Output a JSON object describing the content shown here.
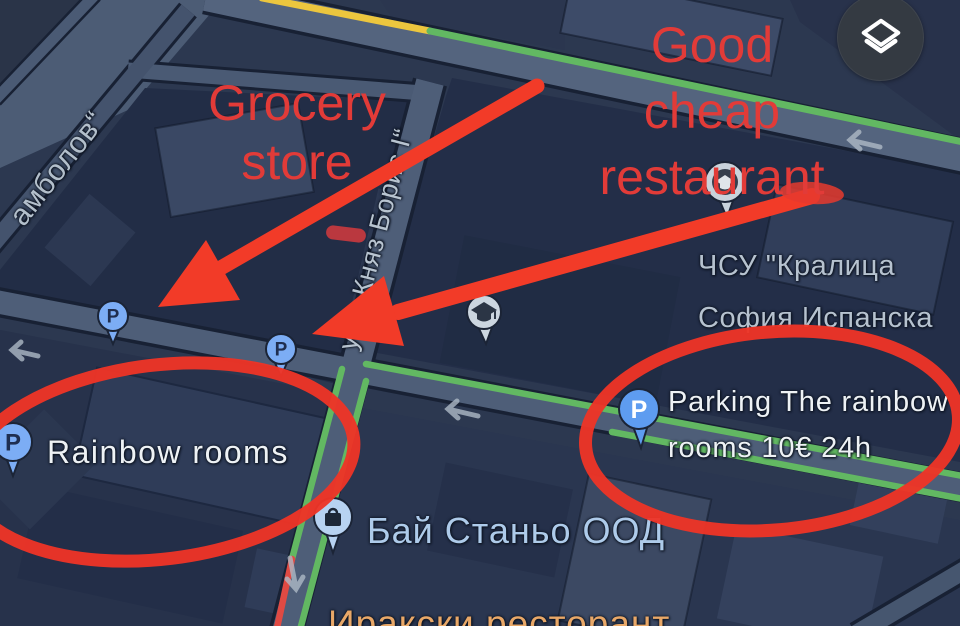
{
  "colors": {
    "annotation_red": "#ee3a2c",
    "pin_blue": "#7cadf5",
    "traffic_green": "#62b862",
    "traffic_yellow": "#ecc63e",
    "traffic_red": "#e04a43",
    "map_background": "#2c3850",
    "label_white": "#eef2f5",
    "label_blue": "#aecbea",
    "label_orange": "#e9a868",
    "label_grey": "#b3bfcb"
  },
  "annotations": {
    "grocery_store": {
      "line1": "Grocery",
      "line2": "store"
    },
    "good_cheap_restaurant": {
      "line1": "Good",
      "line2": "cheap",
      "line3": "restaurant"
    }
  },
  "poi_labels": {
    "rainbow_rooms": "Rainbow rooms",
    "parking": {
      "line1": "Parking The rainbow",
      "line2": "rooms 10€ 24h"
    },
    "school": {
      "line1": "ЧСУ \"Кралица",
      "line2": "София Испанска"
    },
    "bay_stanyo": "Бай Станьо ООД",
    "iraqi_restaurant": "Иракски ресторант"
  },
  "street_labels": {
    "stambolov": "амболов“",
    "knyaz_boris": "ул. „Княз Борис I“"
  },
  "pins": {
    "p_glyph": "P"
  },
  "controls": {
    "layers_icon": "layers"
  }
}
